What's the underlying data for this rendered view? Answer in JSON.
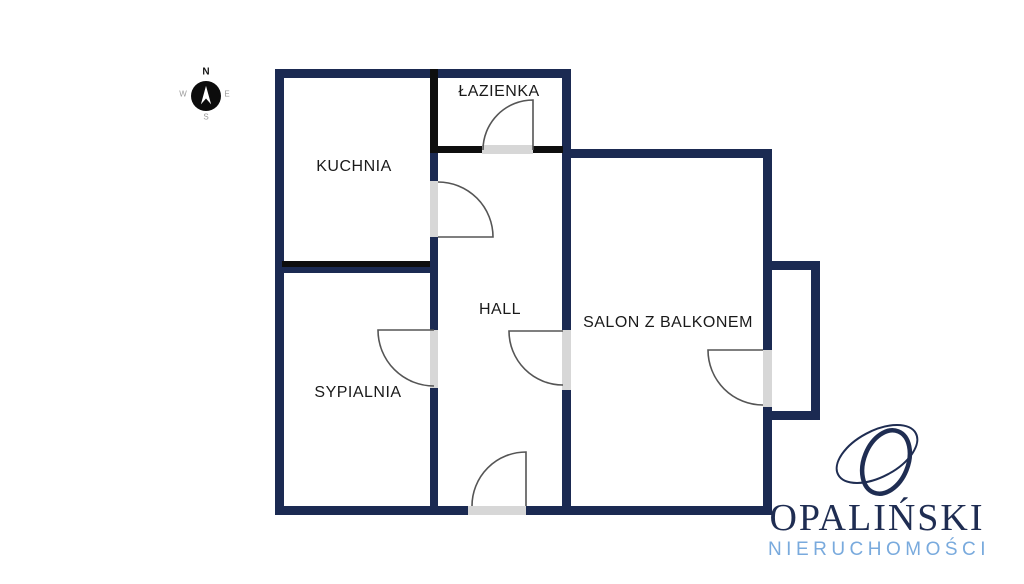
{
  "compass": {
    "n": "N",
    "e": "E",
    "s": "S",
    "w": "W"
  },
  "rooms": [
    {
      "id": "lazienka",
      "label": "ŁAZIENKA"
    },
    {
      "id": "kuchnia",
      "label": "KUCHNIA"
    },
    {
      "id": "hall",
      "label": "HALL"
    },
    {
      "id": "sypialnia",
      "label": "SYPIALNIA"
    },
    {
      "id": "salon",
      "label": "SALON Z BALKONEM"
    }
  ],
  "logo": {
    "name": "OPALIŃSKI",
    "subtitle": "NIERUCHOMOŚCI"
  },
  "colors": {
    "wall_navy": "#1b2a52",
    "wall_black": "#0e0e0e",
    "threshold_gray": "#d7d7d7",
    "arc_gray": "#555555",
    "label_black": "#1a1a1a",
    "compass_gray": "#9a9a9a",
    "logo_navy": "#1f2d52",
    "logo_blue": "#79aadd",
    "bg_white": "#ffffff"
  }
}
